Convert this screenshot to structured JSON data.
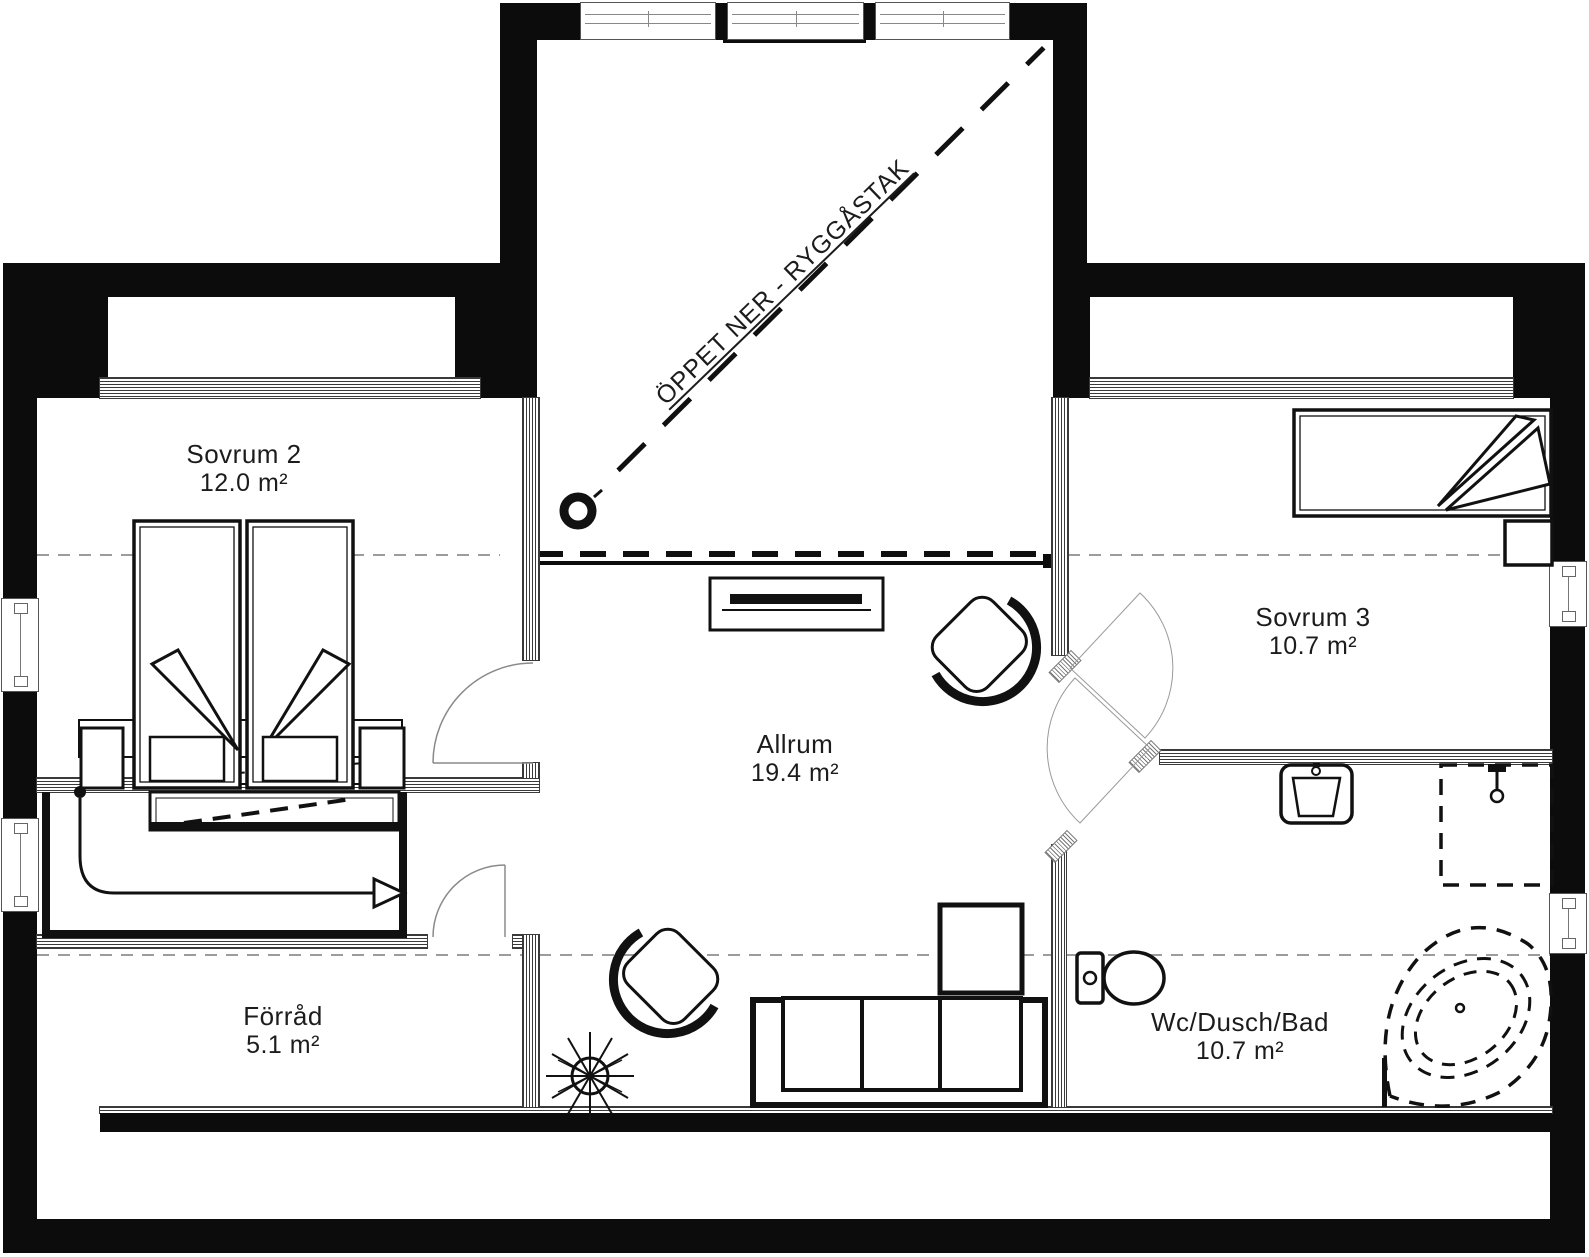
{
  "plan": {
    "annotation": {
      "text": "ÖPPET NER - RYGGÅSTAK"
    },
    "rooms": {
      "sovrum2": {
        "label": "Sovrum 2",
        "area": "12.0 m²"
      },
      "sovrum3": {
        "label": "Sovrum 3",
        "area": "10.7 m²"
      },
      "allrum": {
        "label": "Allrum",
        "area": "19.4 m²"
      },
      "forrad": {
        "label": "Förråd",
        "area": "5.1 m²"
      },
      "wc": {
        "label": "Wc/Dusch/Bad",
        "area": "10.7 m²"
      }
    },
    "colors": {
      "wall": "#0c0c0c",
      "line": "#111111",
      "thin_line": "#999999"
    }
  }
}
